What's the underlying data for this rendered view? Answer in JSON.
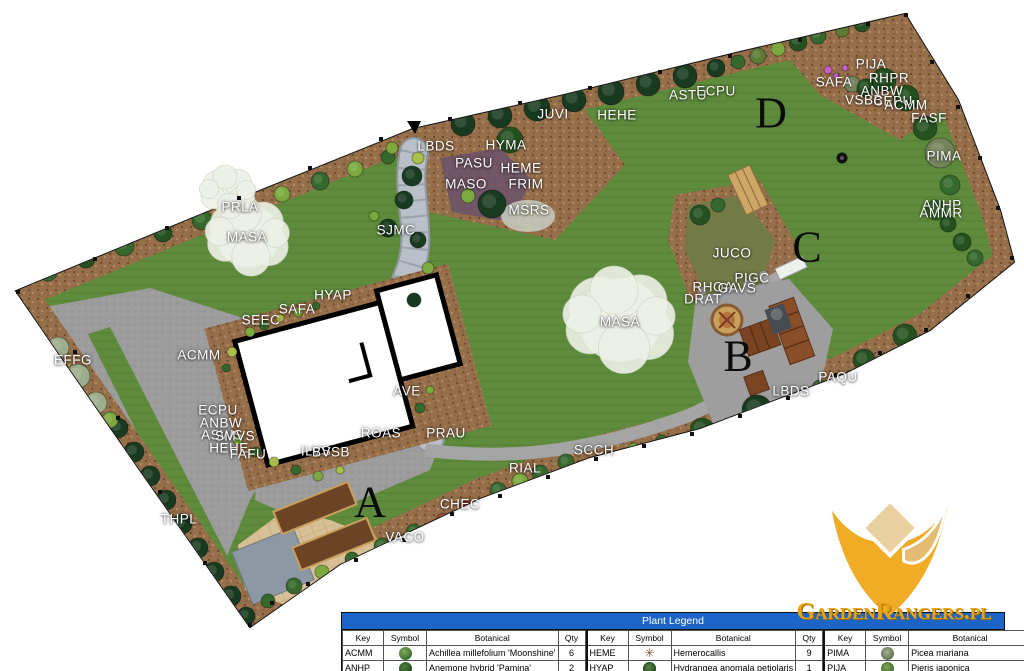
{
  "colors": {
    "grass": "#5f8c3c",
    "mulch": "#956e4a",
    "driveway": "#9c9c9c",
    "stone_path": "#b9c0c7",
    "house_fill": "#ffffff",
    "house_outline": "#000000",
    "legend_header_bg": "#1a65c6",
    "legend_header_text": "#ffffff",
    "logo_gold": "#f0ac25",
    "logo_text_color": "#e7a312",
    "label_color": "#ffffff",
    "zone_letter_color": "#0b0b0b"
  },
  "plan": {
    "labels": [
      {
        "t": "PRLA",
        "x": 240,
        "y": 207
      },
      {
        "t": "MASA",
        "x": 247,
        "y": 237
      },
      {
        "t": "SJMC",
        "x": 396,
        "y": 230
      },
      {
        "t": "LBDS",
        "x": 436,
        "y": 146
      },
      {
        "t": "HYMA",
        "x": 506,
        "y": 145
      },
      {
        "t": "PASU",
        "x": 474,
        "y": 163
      },
      {
        "t": "MASO",
        "x": 466,
        "y": 184
      },
      {
        "t": "HEME",
        "x": 521,
        "y": 168
      },
      {
        "t": "FRIM",
        "x": 526,
        "y": 184
      },
      {
        "t": "MSRS",
        "x": 529,
        "y": 210
      },
      {
        "t": "JUVI",
        "x": 553,
        "y": 114
      },
      {
        "t": "HEHE",
        "x": 617,
        "y": 115
      },
      {
        "t": "ASTU",
        "x": 688,
        "y": 95
      },
      {
        "t": "ECPU",
        "x": 716,
        "y": 91
      },
      {
        "t": "SAFA",
        "x": 834,
        "y": 82
      },
      {
        "t": "PIJA",
        "x": 871,
        "y": 64
      },
      {
        "t": "RHPR",
        "x": 889,
        "y": 78
      },
      {
        "t": "ANBW",
        "x": 882,
        "y": 91
      },
      {
        "t": "VSBB",
        "x": 864,
        "y": 100
      },
      {
        "t": "CEPU",
        "x": 893,
        "y": 101
      },
      {
        "t": "ACMM",
        "x": 906,
        "y": 105
      },
      {
        "t": "FASF",
        "x": 929,
        "y": 118
      },
      {
        "t": "PIMA",
        "x": 944,
        "y": 156
      },
      {
        "t": "ANHP",
        "x": 942,
        "y": 205
      },
      {
        "t": "AMMR",
        "x": 941,
        "y": 213
      },
      {
        "t": "JUCO",
        "x": 732,
        "y": 253
      },
      {
        "t": "PIGC",
        "x": 752,
        "y": 278
      },
      {
        "t": "RHOA",
        "x": 713,
        "y": 287
      },
      {
        "t": "GAVS",
        "x": 737,
        "y": 288
      },
      {
        "t": "DRAT",
        "x": 703,
        "y": 299
      },
      {
        "t": "MASA",
        "x": 620,
        "y": 322
      },
      {
        "t": "HYAP",
        "x": 333,
        "y": 295
      },
      {
        "t": "SAFA",
        "x": 297,
        "y": 309
      },
      {
        "t": "SEEC",
        "x": 261,
        "y": 320
      },
      {
        "t": "ACMM",
        "x": 199,
        "y": 355
      },
      {
        "t": "EFFG",
        "x": 73,
        "y": 360
      },
      {
        "t": "ECPU",
        "x": 218,
        "y": 410
      },
      {
        "t": "ANBW",
        "x": 221,
        "y": 423
      },
      {
        "t": "ASWS",
        "x": 222,
        "y": 435
      },
      {
        "t": "SMVS",
        "x": 235,
        "y": 436
      },
      {
        "t": "HEHE",
        "x": 229,
        "y": 448
      },
      {
        "t": "FAFU",
        "x": 248,
        "y": 454
      },
      {
        "t": "AVE",
        "x": 407,
        "y": 391
      },
      {
        "t": "ROAS",
        "x": 381,
        "y": 433
      },
      {
        "t": "PRAU",
        "x": 446,
        "y": 433
      },
      {
        "t": "ILVS",
        "x": 316,
        "y": 451
      },
      {
        "t": "BVSB",
        "x": 331,
        "y": 452
      },
      {
        "t": "THPL",
        "x": 179,
        "y": 519
      },
      {
        "t": "VACO",
        "x": 405,
        "y": 537
      },
      {
        "t": "CHEC",
        "x": 460,
        "y": 504
      },
      {
        "t": "RIAL",
        "x": 525,
        "y": 468
      },
      {
        "t": "SCCH",
        "x": 594,
        "y": 450
      },
      {
        "t": "LBDS",
        "x": 791,
        "y": 391
      },
      {
        "t": "PAQU",
        "x": 838,
        "y": 377
      }
    ],
    "zone_letters": [
      {
        "t": "A",
        "x": 370,
        "y": 502
      },
      {
        "t": "B",
        "x": 738,
        "y": 356
      },
      {
        "t": "C",
        "x": 807,
        "y": 247
      },
      {
        "t": "D",
        "x": 771,
        "y": 113
      }
    ]
  },
  "legend": {
    "title": "Plant Legend",
    "columns": [
      "Key",
      "Symbol",
      "Botanical",
      "Qty"
    ],
    "groups": [
      [
        {
          "key": "ACMM",
          "symbol": "green-mound",
          "botanical": "Achillea millefolium 'Moonshine'",
          "qty": "6"
        },
        {
          "key": "ANHP",
          "symbol": "dark-green-mound",
          "botanical": "Anemone hybrid 'Pamina'",
          "qty": "2"
        }
      ],
      [
        {
          "key": "HEME",
          "symbol": "asterisk",
          "botanical": "Hemerocallis",
          "qty": "9"
        },
        {
          "key": "HYAP",
          "symbol": "textured-mound",
          "botanical": "Hydrangea anomala petiolaris",
          "qty": "1"
        }
      ],
      [
        {
          "key": "PIMA",
          "symbol": "spiky-gray-mound",
          "botanical": "Picea mariana",
          "qty": "3"
        },
        {
          "key": "PIJA",
          "symbol": "spiky-green-mound",
          "botanical": "Pieris japonica",
          "qty": "1"
        }
      ]
    ]
  },
  "logo": {
    "text": "GardenRangers.pl"
  }
}
